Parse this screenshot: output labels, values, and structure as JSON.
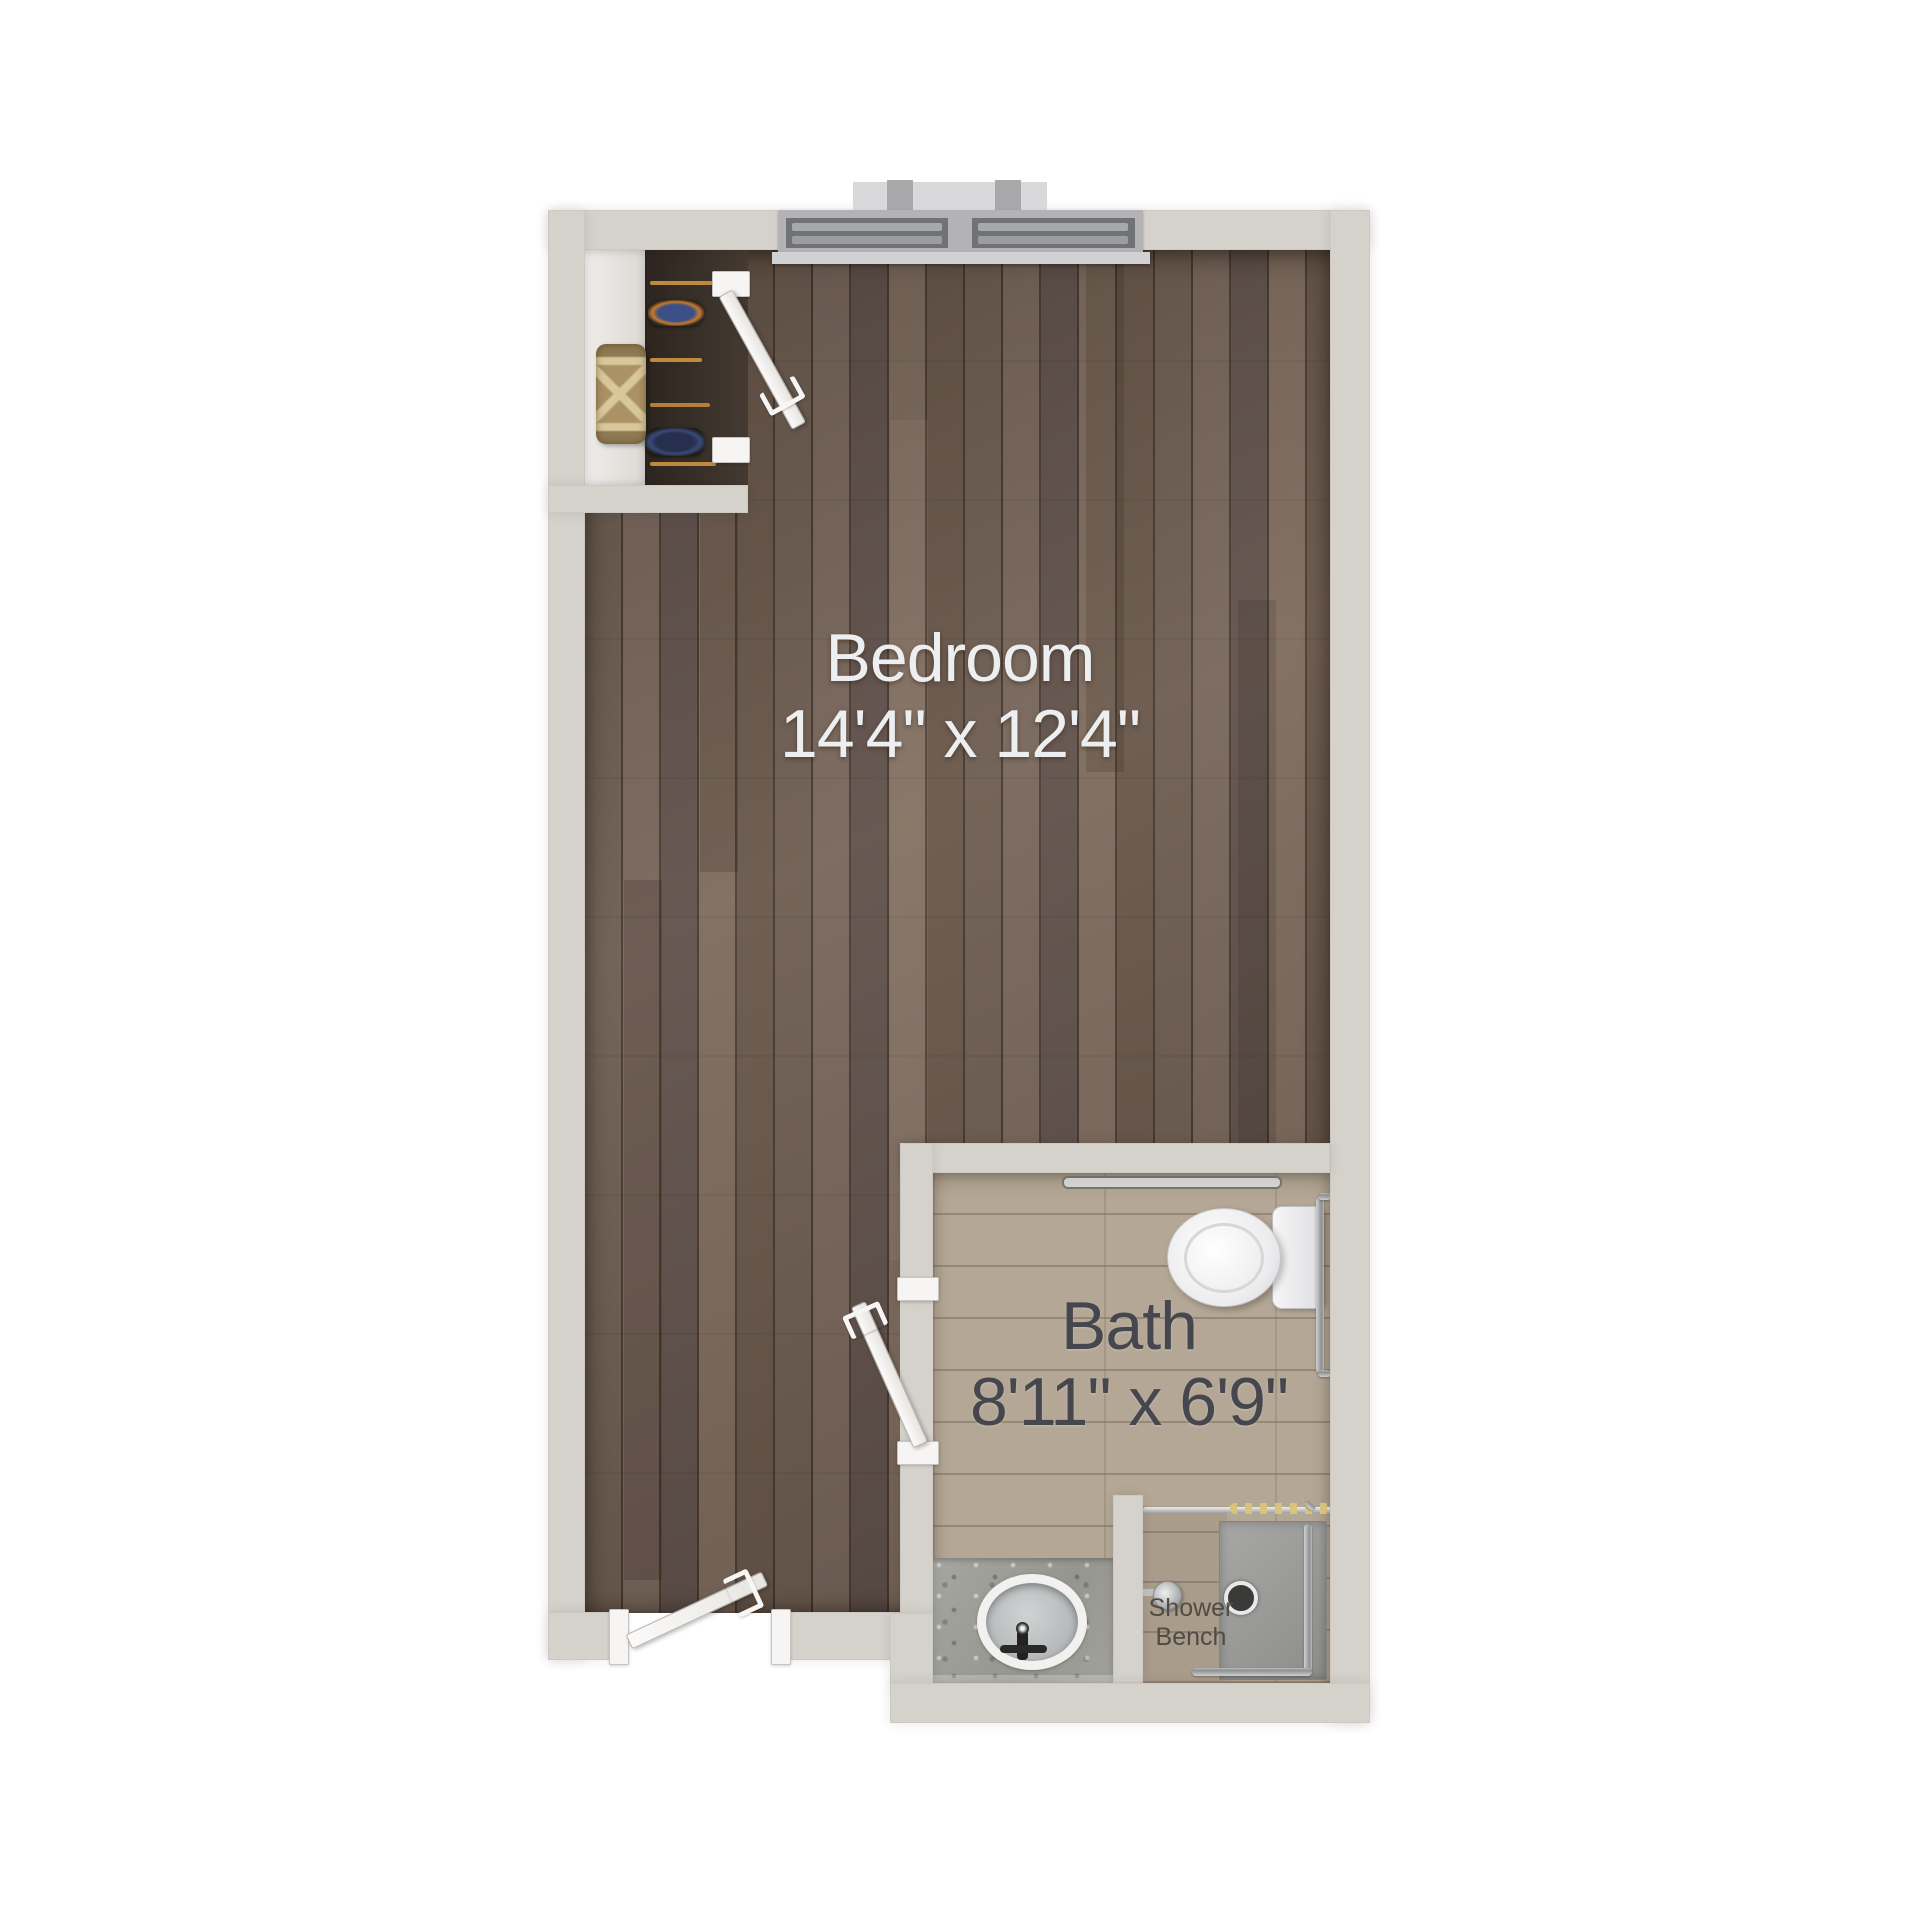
{
  "plan": {
    "bedroom": {
      "label": "Bedroom",
      "dimensions": "14'4\" x 12'4\""
    },
    "bath": {
      "label": "Bath",
      "dimensions": "8'11\" x 6'9\""
    },
    "shower_bench": {
      "line1": "Shower",
      "line2": "Bench"
    }
  },
  "colors": {
    "background": "#ffffff",
    "wall": "#d5d1cb",
    "wood_floor": "#6d5c50",
    "bath_tile": "#b4a795",
    "shower_bench_tile": "#a99c8b",
    "shower_tray": "#989896",
    "counter_granite": "#9e9e9a",
    "fixture_white": "#f3f3f4",
    "chrome": "#a0a2a4",
    "closet_interior": "#352c25",
    "rug_tan": "#ab9265",
    "hanger_rod_gold": "#c08a3e",
    "curtain_hook_gold": "#d9c47e",
    "window_frame": "#b3b3b5",
    "label_light": "#eceef0",
    "label_dark": "#46464e"
  }
}
